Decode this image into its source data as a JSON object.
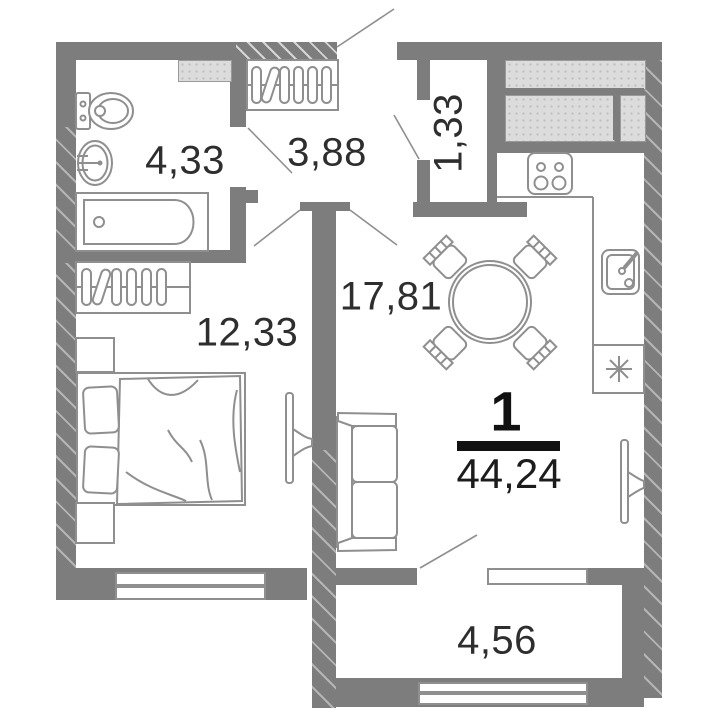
{
  "plan": {
    "apartment": {
      "rooms_count_badge": "1",
      "total_area": "44,24"
    },
    "rooms": {
      "bathroom": {
        "area": "4,33"
      },
      "hallway": {
        "area": "3,88"
      },
      "closet": {
        "area": "1,33"
      },
      "bedroom": {
        "area": "12,33"
      },
      "living_kitchen": {
        "area": "17,81"
      },
      "balcony": {
        "area": "4,56"
      }
    },
    "colors": {
      "background": "#ffffff",
      "wall": "#7d7d7d",
      "wall_hatch_line": "#b5b5b5",
      "furniture_stroke": "#8f8f8f",
      "vent_shaft_fill": "#dcdcdc",
      "room_label_text": "#2e2e2e",
      "apartment_number_text": "#111111"
    }
  }
}
